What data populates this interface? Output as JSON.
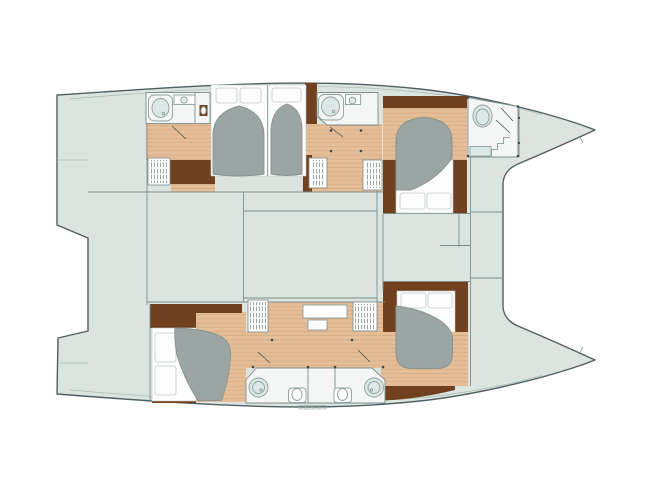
{
  "canvas": {
    "width": 650,
    "height": 490,
    "background": "#ffffff"
  },
  "colors": {
    "deck": "#dbe4de",
    "hull_outline": "#4f5f64",
    "partition_line": "#7c8e8c",
    "rail_line": "#a9bab5",
    "wood_floor": "#e5bd97",
    "wood_plank_line": "#cfa87f",
    "wood_dark": "#71411f",
    "bed_duvet": "#9aa5a4",
    "bed_duvet_edge": "#86938f",
    "mattress": "#fcfdfc",
    "pillow_edge": "#bfcac6",
    "bathroom_floor": "#f3f6f4",
    "fixture_fill": "#dde7e5",
    "fixture_edge": "#8da09e",
    "louver_line": "#7e8f8d",
    "door_dot": "#3e4a4d",
    "keel_mark": "#9fb0ab"
  }
}
